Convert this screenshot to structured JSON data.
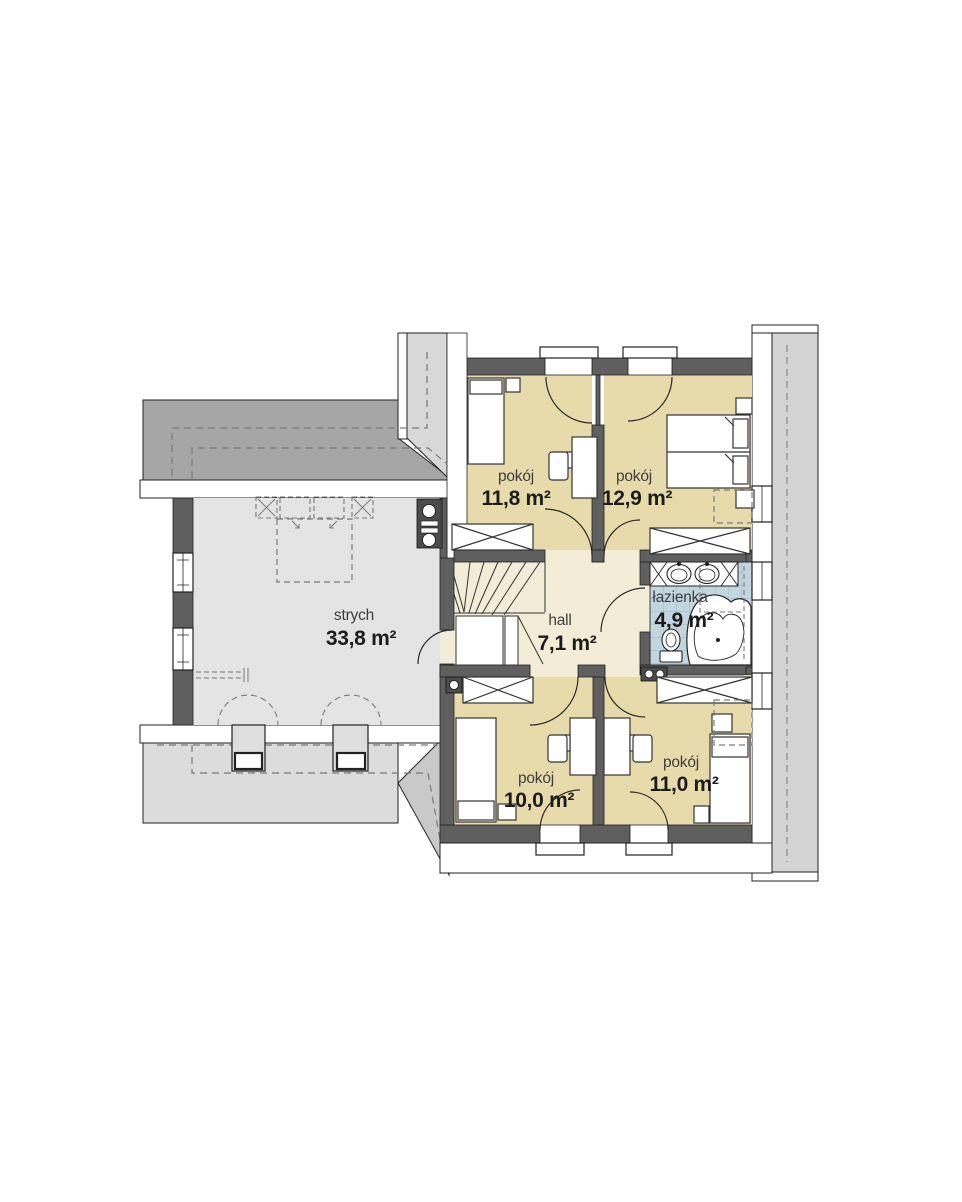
{
  "plan": {
    "rooms": [
      {
        "id": "room-top-left",
        "name": "pokój",
        "area": "11,8 m²"
      },
      {
        "id": "room-top-right",
        "name": "pokój",
        "area": "12,9 m²"
      },
      {
        "id": "hall",
        "name": "hall",
        "area": "7,1 m²"
      },
      {
        "id": "bathroom",
        "name": "łazienka",
        "area": "4,9 m²"
      },
      {
        "id": "room-bottom-left",
        "name": "pokój",
        "area": "10,0 m²"
      },
      {
        "id": "room-bottom-right",
        "name": "pokój",
        "area": "11,0 m²"
      },
      {
        "id": "attic",
        "name": "strych",
        "area": "33,8 m²"
      }
    ],
    "colors": {
      "room_floor": "#e7dbab",
      "hall_floor": "#f3edd8",
      "bath_tile": "#c3d6e0",
      "attic_floor": "#e4e4e4",
      "roof_dark": "#a6a6a6",
      "roof_light": "#dcdcdc",
      "roof_side": "#d4d4d4",
      "wall": "#5f5f5f"
    }
  }
}
